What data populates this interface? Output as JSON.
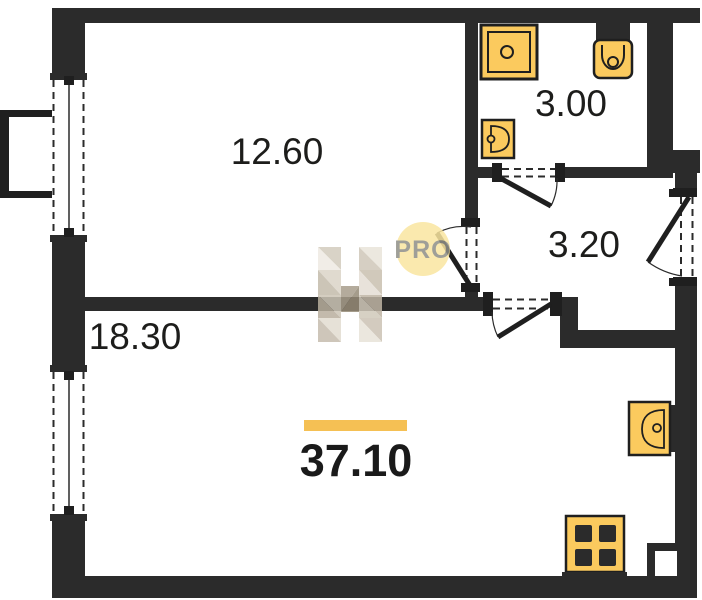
{
  "plan": {
    "type": "apartment-floor-plan",
    "rooms": [
      {
        "id": "bedroom",
        "area": "12.60"
      },
      {
        "id": "bathroom",
        "area": "3.00"
      },
      {
        "id": "hallway",
        "area": "3.20"
      },
      {
        "id": "living-room",
        "area": "18.30"
      }
    ],
    "total_area": "37.10",
    "fixtures": [
      "shower-icon",
      "toilet-icon",
      "washbasin-icon",
      "kitchen-sink-icon",
      "stove-icon"
    ],
    "features": [
      "balcony",
      "window",
      "entrance-door",
      "interior-doors"
    ]
  },
  "watermark": {
    "logo_letter": "H",
    "pro": "PRO"
  },
  "colors": {
    "wall": "#2b2b2b",
    "fixture_fill": "#fbca5e",
    "fixture_stroke": "#1f1f1f",
    "accent_bar": "#f5c054",
    "watermark_circle": "#fae6a0",
    "watermark_text": "#8f8f87",
    "label": "#1d1d1b"
  }
}
